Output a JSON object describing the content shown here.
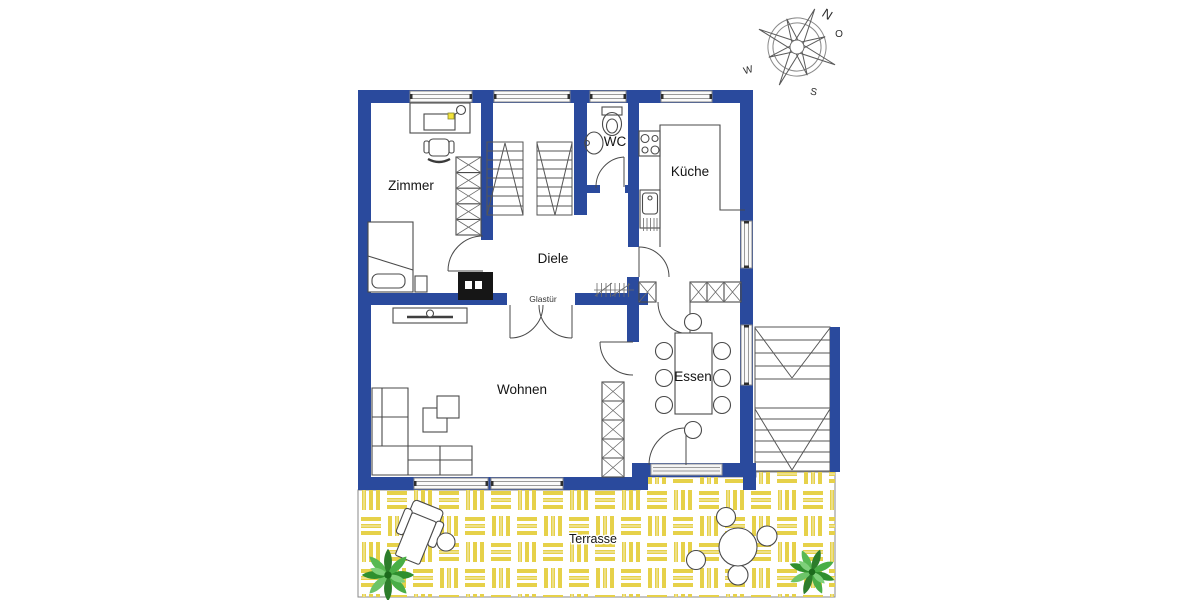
{
  "rooms": {
    "zimmer": "Zimmer",
    "kueche": "Küche",
    "wc": "WC",
    "diele": "Diele",
    "wohnen": "Wohnen",
    "essen": "Essen",
    "terrasse": "Terrasse"
  },
  "annotations": {
    "glass_door": "Glastür"
  },
  "compass": {
    "north": "N",
    "east": "O",
    "south": "S",
    "west": "W"
  },
  "colors": {
    "wall_blue": "#2a4a9d",
    "terrace_yellow": "#e6d149",
    "plant_green": "#3a9c39",
    "lamp_yellow": "#f2e23a",
    "outline_gray": "#4a4a4a"
  }
}
